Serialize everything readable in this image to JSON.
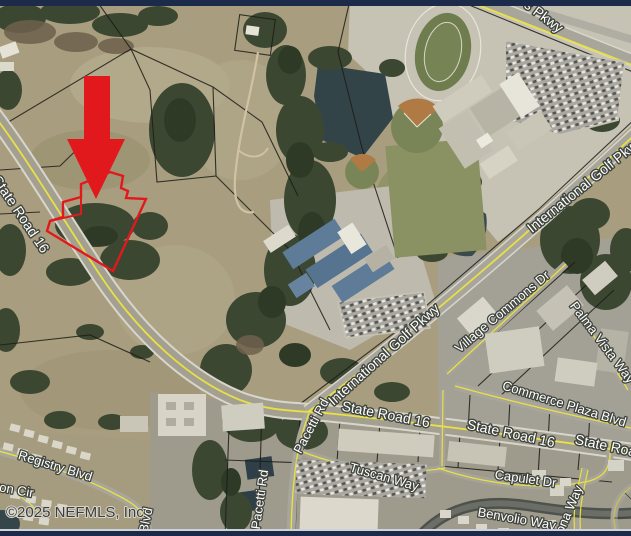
{
  "attribution": "©2025 NEFMLS, Inc",
  "marker": {
    "type": "down-arrow",
    "color": "#e2191c",
    "points_to": "subject-property-parcel"
  },
  "subject_parcel": {
    "outline_color": "#e2191c"
  },
  "colors": {
    "letterbox_bar": "#1c2b4a",
    "road_centerline_yellow": "#e9e041",
    "label_text": "#ffffff",
    "label_halo": "#3f443c",
    "attribution_text": "#3d3d3d",
    "water": "#35464b"
  },
  "road_labels": [
    {
      "text": "s Pkwy"
    },
    {
      "text": "International Golf Pkwy"
    },
    {
      "text": "International Golf Pkwy"
    },
    {
      "text": "Village Commons Dr"
    },
    {
      "text": "Palma Vista Way"
    },
    {
      "text": "Commerce Plaza Blvd"
    },
    {
      "text": "State Road 16"
    },
    {
      "text": "State Road 16"
    },
    {
      "text": "State Road 16"
    },
    {
      "text": "Pacetti Rd"
    },
    {
      "text": "Pacetti Rd"
    },
    {
      "text": "Tuscan Way"
    },
    {
      "text": "Capulet Dr"
    },
    {
      "text": "Benvolio Way"
    },
    {
      "text": "ona Way"
    },
    {
      "text": "Registry Blvd"
    },
    {
      "text": "ton Cir"
    },
    {
      "text": "Blvd"
    },
    {
      "text": "State Road 16"
    }
  ]
}
